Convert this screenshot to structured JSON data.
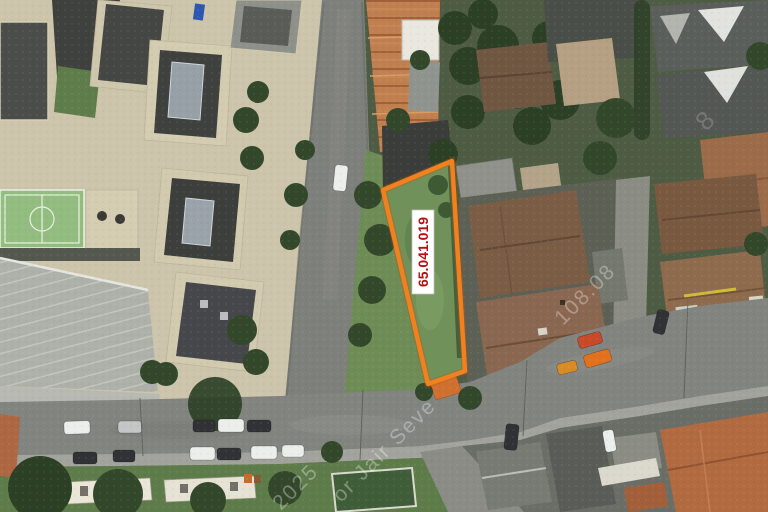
{
  "parcel": {
    "label": "65.041.019",
    "outline_color": "#f08020",
    "outline_undercolor": "#b35a0e",
    "label_text_color": "#b01111",
    "label_bg_color": "#ffffff"
  },
  "watermark": {
    "fragments": [
      {
        "text": "2025"
      },
      {
        "text": "or Jair Seve"
      },
      {
        "text": "108.08"
      },
      {
        "text": "8"
      }
    ]
  },
  "scene_colors": {
    "asphalt": "#828480",
    "complex_ground_beige": "#cdc5ab",
    "dark_roof": "#454745",
    "sports_court_green": "#93bd80",
    "warehouse_roof": "#aeb1aa",
    "vegetation_dark": "#4f5c44",
    "brown_roof": "#8a6750",
    "terracotta_roof": "#b26a41",
    "row_house_tiles": "#c07f4e"
  }
}
